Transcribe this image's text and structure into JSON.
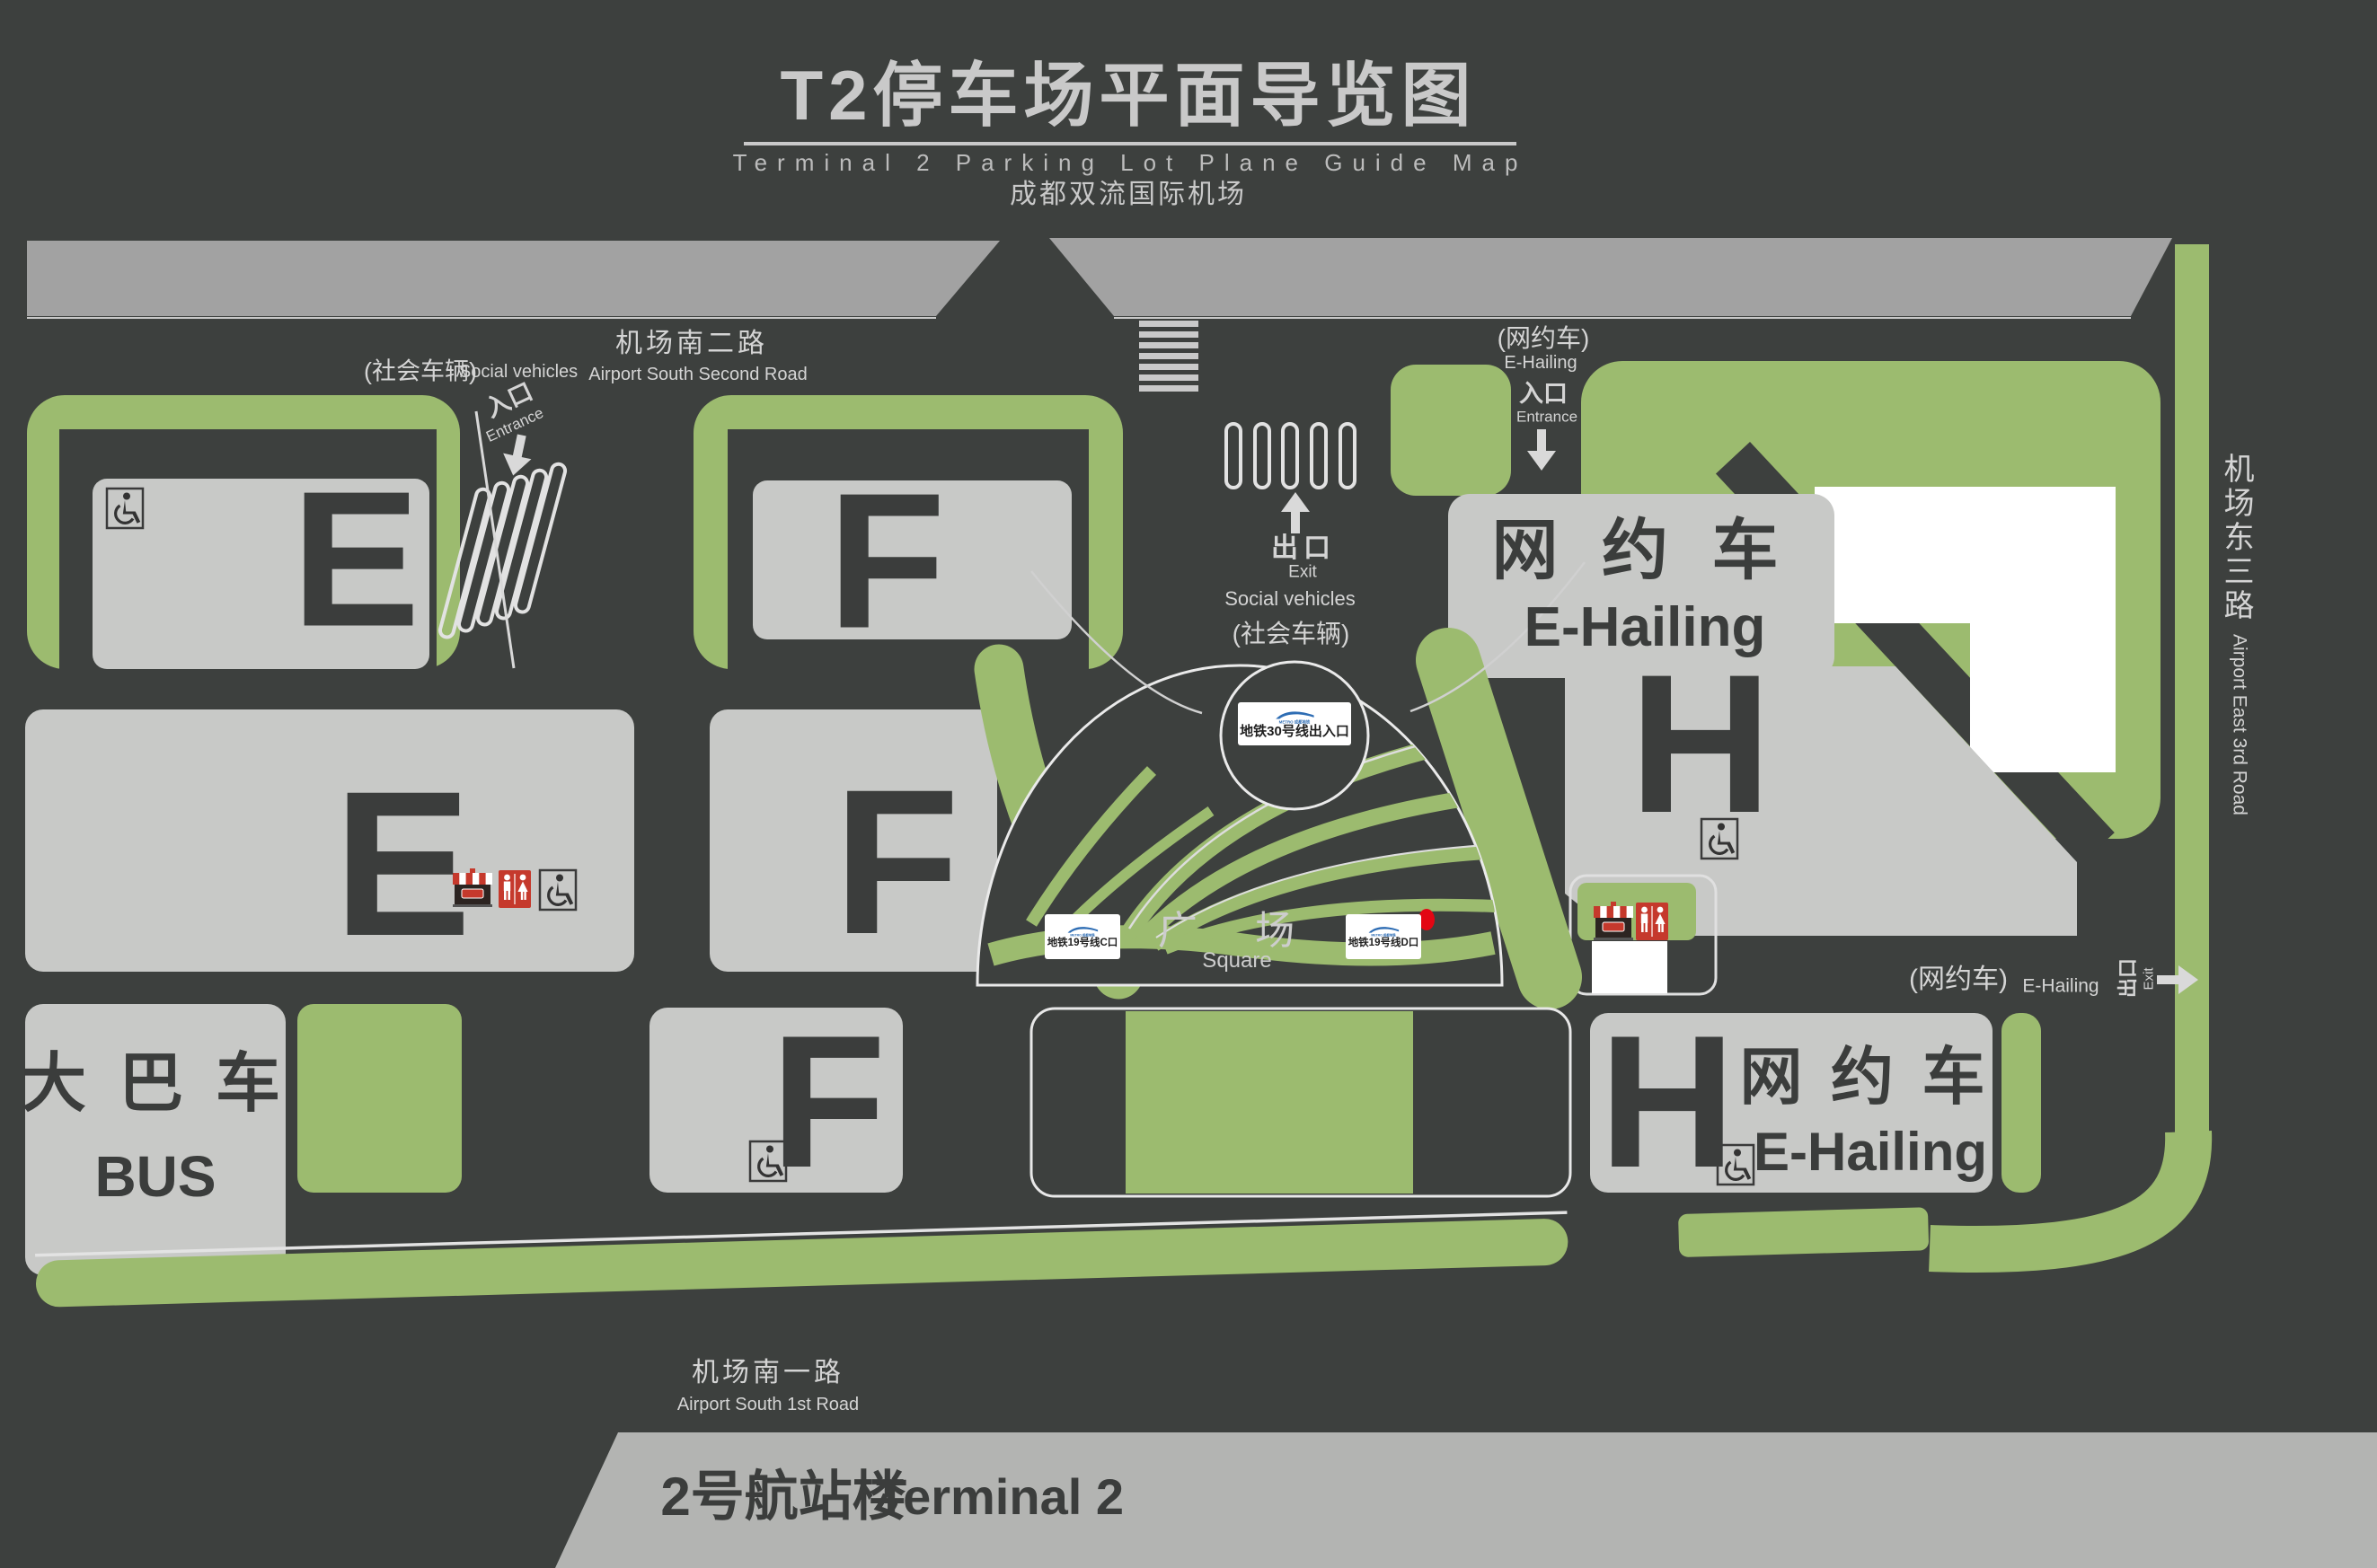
{
  "header": {
    "title_zh": "T2停车场平面导览图",
    "title_en": "Terminal 2 Parking Lot Plane Guide Map",
    "airport": "成都双流国际机场"
  },
  "roads": {
    "south2_zh": "机场南二路",
    "south2_en": "Airport South Second Road",
    "south1_zh": "机场南一路",
    "south1_en": "Airport South 1st Road",
    "east3_zh": "机场东三路",
    "east3_en": "Airport East 3rd Road"
  },
  "gates": {
    "social_label_zh": "(社会车辆)",
    "social_label_en": "Social vehicles",
    "entrance_zh": "入口",
    "entrance_en": "Entrance",
    "exit_zh": "出口",
    "exit_en": "Exit",
    "ehailing_label_zh": "(网约车)",
    "ehailing_label_en": "E-Hailing"
  },
  "zones": {
    "e": "E",
    "f": "F",
    "h": "H",
    "bus_zh": "大 巴 车",
    "bus_en": "BUS",
    "ehailing_zh": "网 约 车",
    "ehailing_en": "E-Hailing"
  },
  "plaza": {
    "zh": "广 场",
    "en": "Square"
  },
  "metro": {
    "line30": "地铁30号线出入口",
    "line19c": "地铁19号线C口",
    "line19d": "地铁19号线D口",
    "brand": "METRO 成都地铁"
  },
  "terminal": {
    "zh": "2号航站楼",
    "en": "Terminal 2"
  },
  "colors": {
    "bg": "#3d403e",
    "green": "#9cbb6f",
    "parking": "#c8c9c7",
    "road": "#a2a2a2",
    "terminal_bar": "#b3b4b2",
    "letter": "#3b3d3c",
    "white": "#ffffff",
    "restroom_red": "#c5392c",
    "metro_blue": "#2e6db4",
    "dot_red": "#e30613"
  }
}
